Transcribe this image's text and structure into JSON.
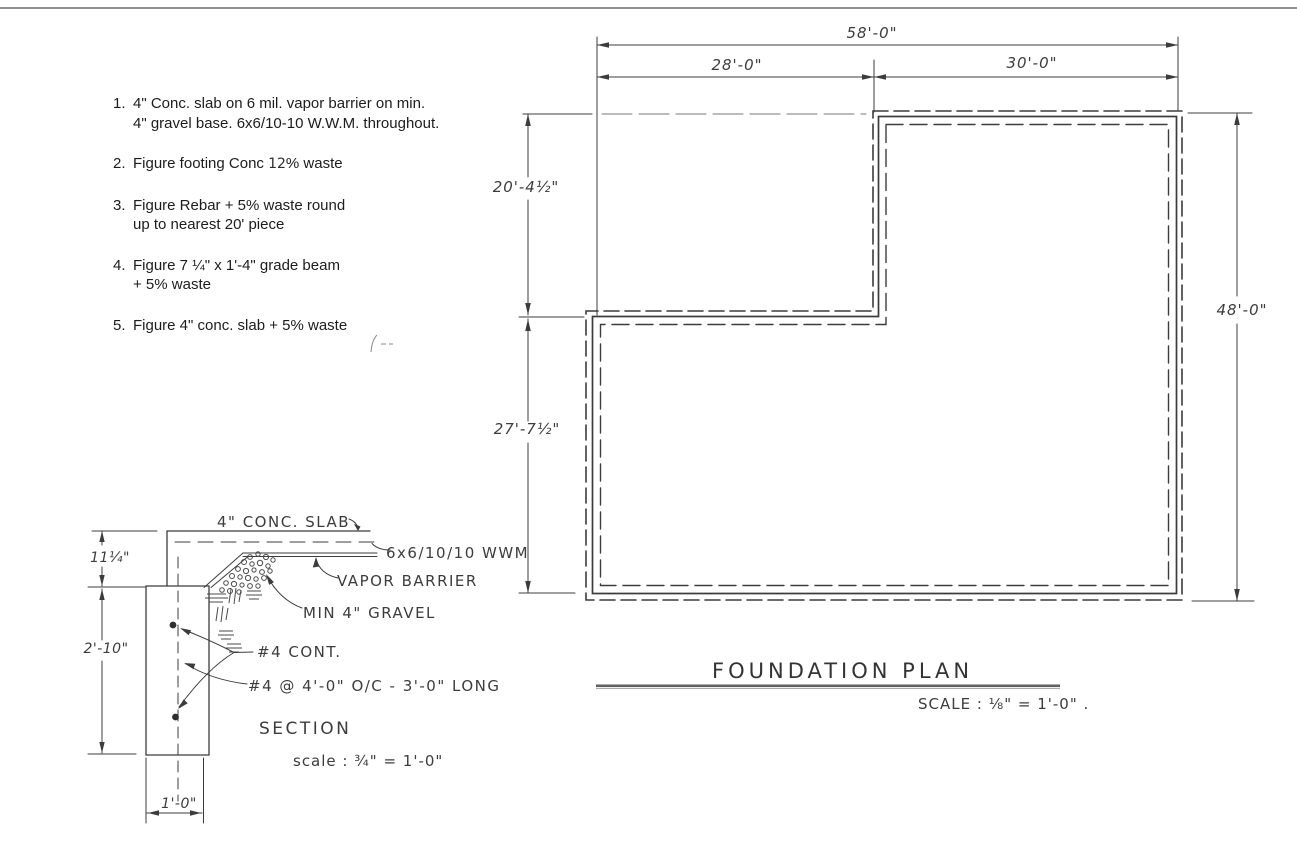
{
  "page": {
    "background": "#ffffff",
    "ink_color": "#3c3c3c",
    "notes_color": "#1c1c1c"
  },
  "notes": {
    "items": [
      {
        "num": "1.",
        "line1": "4\" Conc. slab on 6 mil. vapor barrier on min.",
        "line2": "4\" gravel base.  6x6/10-10 W.W.M. throughout."
      },
      {
        "num": "2.",
        "pre": "Figure footing Conc ",
        "hand": "12",
        "post": "% waste"
      },
      {
        "num": "3.",
        "line1": "Figure Rebar + 5% waste round",
        "line2": "up to nearest 20' piece"
      },
      {
        "num": "4.",
        "line1": "Figure 7 ¼\" x 1'-4\" grade beam",
        "line2": "+ 5% waste"
      },
      {
        "num": "5.",
        "line1": "Figure 4\" conc. slab + 5% waste"
      }
    ]
  },
  "plan": {
    "title": "FOUNDATION PLAN",
    "scale": "SCALE : ⅛\" = 1'-0\" .",
    "dims": {
      "total_width": "58'-0\"",
      "left_width": "28'-0\"",
      "right_width": "30'-0\"",
      "upper_left_height": "20'-4½\"",
      "lower_left_height": "27'-7½\"",
      "right_height": "48'-0\""
    }
  },
  "section": {
    "title": "SECTION",
    "scale": "scale : ¾\" = 1'-0\"",
    "labels": {
      "slab": "4\" CONC. SLAB",
      "wwm": "6x6/10/10 WWM",
      "vapor_barrier": "VAPOR BARRIER",
      "gravel": "MIN 4\" GRAVEL",
      "rebar_continuous": "#4 CONT.",
      "rebar_dowels": "#4 @ 4'-0\" O/C - 3'-0\" LONG"
    },
    "dims": {
      "slab_edge_depth": "11¼\"",
      "footing_depth": "2'-10\"",
      "footing_width": "1'-0\""
    }
  }
}
